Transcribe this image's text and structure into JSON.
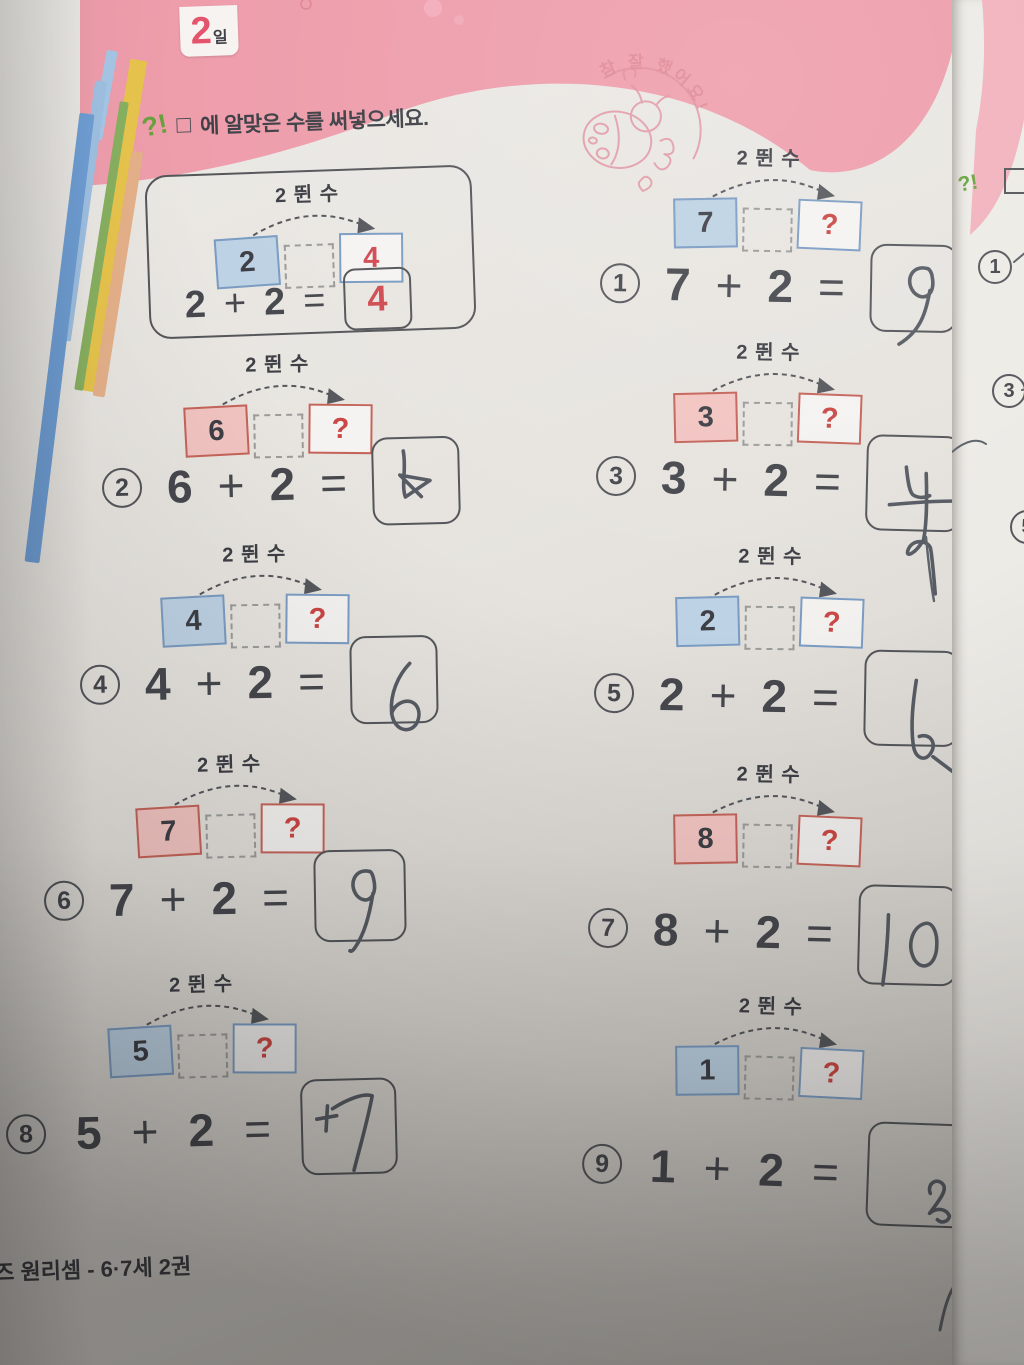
{
  "header": {
    "day_number": "2",
    "day_suffix": "일"
  },
  "instruction": {
    "icon_text": "?!",
    "box_symbol": "□",
    "text": "에 알맞은 수를 써넣으세요."
  },
  "stamp": {
    "text": "참 잘 했어요!"
  },
  "shared": {
    "jump_label": "2 뛴 수",
    "plus": "+",
    "equals": "=",
    "question_mark": "?"
  },
  "example": {
    "start": "2",
    "addend": "2",
    "result": "4"
  },
  "problems": [
    {
      "num": "1",
      "start": "7",
      "addend": "2",
      "color": "blue",
      "written_answer": "9"
    },
    {
      "num": "2",
      "start": "6",
      "addend": "2",
      "color": "red",
      "written_answer": "8"
    },
    {
      "num": "3",
      "start": "3",
      "addend": "2",
      "color": "red",
      "written_answer": "4"
    },
    {
      "num": "4",
      "start": "4",
      "addend": "2",
      "color": "blue",
      "written_answer": "6"
    },
    {
      "num": "5",
      "start": "2",
      "addend": "2",
      "color": "blue",
      "written_answer": "4"
    },
    {
      "num": "6",
      "start": "7",
      "addend": "2",
      "color": "red",
      "written_answer": "9"
    },
    {
      "num": "7",
      "start": "8",
      "addend": "2",
      "color": "red",
      "written_answer": "10"
    },
    {
      "num": "8",
      "start": "5",
      "addend": "2",
      "color": "blue",
      "written_answer": "7"
    },
    {
      "num": "9",
      "start": "1",
      "addend": "2",
      "color": "blue",
      "written_answer": "2"
    }
  ],
  "footer": {
    "text": "즈 원리셈 - 6·7세 2권"
  },
  "next_page": {
    "visible_numbers": [
      "1",
      "3",
      "5"
    ]
  },
  "colors": {
    "header_pink": "#ee9dab",
    "tab_number_red": "#e4536b",
    "box_blue_fill": "#bdd2e4",
    "box_blue_border": "#7b9cc2",
    "box_red_fill": "#f2c4c1",
    "box_red_border": "#c4645a",
    "question_red": "#c94744",
    "answer_red": "#d14b52",
    "pencil_gray": "#575c64",
    "stamp_pink": "#e08c9c",
    "icon_green": "#68a13e"
  }
}
